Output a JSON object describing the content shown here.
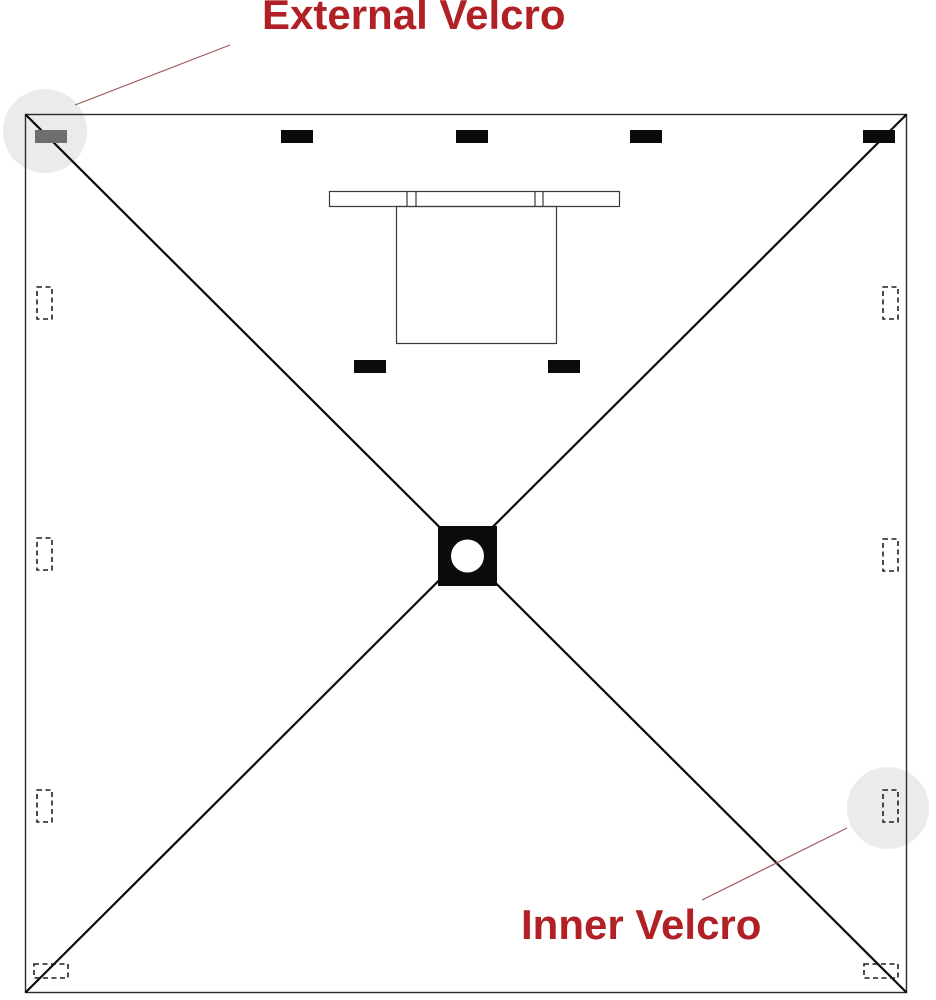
{
  "diagram": {
    "kind": "canopy-top-velcro-placement-diagram",
    "labels": {
      "external_velcro": "External Velcro",
      "inner_velcro": "Inner Velcro"
    },
    "marks": {
      "solid_external_strips": 7,
      "dashed_inner_patches": 8,
      "highlight_circles": 2
    }
  },
  "colors": {
    "label_red": "#B02025",
    "callout_line": "#A35B5B",
    "ink": "#0B0B0B",
    "outline": "#2B2B2B",
    "gray_strip": "#6E6E6E",
    "highlight": "#EBEBEB",
    "background": "#FFFFFF"
  }
}
